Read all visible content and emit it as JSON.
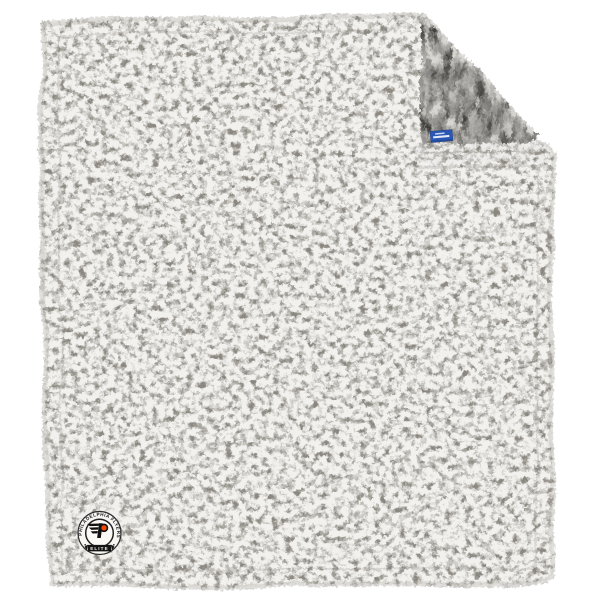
{
  "scene": {
    "background_color": "#ffffff",
    "subject": "sherpa fleece blanket with folded top-right corner"
  },
  "blanket": {
    "front_color": "#f2f1ee",
    "front_speckle_color": "#8a8782",
    "edge_band_color": "#c9c5c0",
    "back_color": "#969490",
    "back_streak_color": "#3c3a37",
    "hem_stitch_color": "#d6d3ce",
    "fold_hem_color": "#edecea"
  },
  "badge": {
    "top_text": "PHILADELPHIA FLYERS",
    "banner_text": "ELITE",
    "background_color": "#f7f6f3",
    "ring_color": "#262626",
    "ribbon_color": "#141414",
    "logo_black": "#111111",
    "logo_orange": "#f74902"
  },
  "tag": {
    "color": "#2a57b4",
    "edge_color": "#1c3f85",
    "text_line_color": "#eef2fb"
  }
}
